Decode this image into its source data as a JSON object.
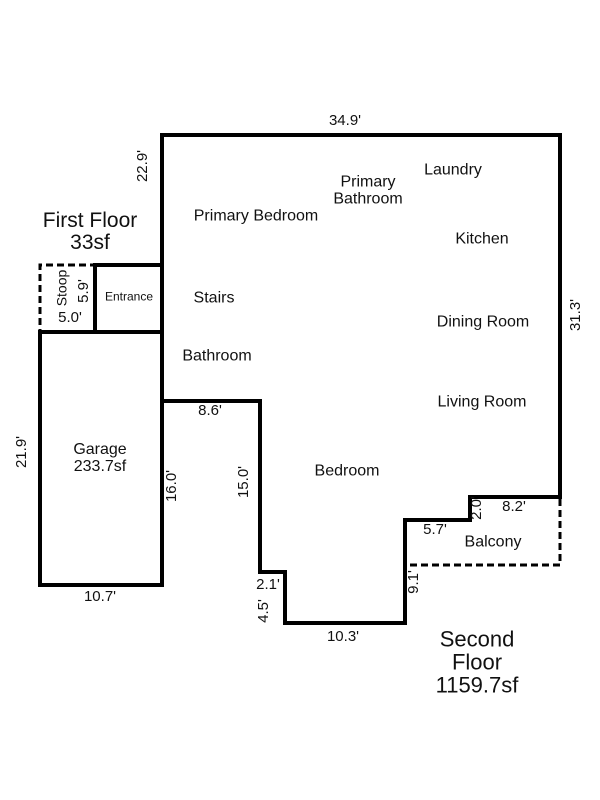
{
  "colors": {
    "walls": "#000000",
    "text": "#111111",
    "background": "#ffffff"
  },
  "first_floor": {
    "title": "First Floor",
    "area": "33sf",
    "rooms": {
      "stoop": "Stoop",
      "entrance": "Entrance"
    },
    "dimensions": {
      "stoop_width": "5.0'",
      "stoop_depth": "5.9'"
    }
  },
  "garage": {
    "name": "Garage",
    "area": "233.7sf",
    "dimensions": {
      "left_height": "21.9'",
      "bottom_width": "10.7'",
      "right_wall": "16.0'"
    }
  },
  "second_floor": {
    "title": "Second Floor",
    "area": "1159.7sf",
    "rooms": {
      "primary_bedroom": "Primary Bedroom",
      "primary_bathroom": "Primary\nBathroom",
      "laundry": "Laundry",
      "kitchen": "Kitchen",
      "dining_room": "Dining Room",
      "living_room": "Living Room",
      "stairs": "Stairs",
      "bathroom": "Bathroom",
      "bedroom": "Bedroom",
      "balcony": "Balcony"
    },
    "dimensions": {
      "top_width": "34.9'",
      "upper_left_height": "22.9'",
      "right_height": "31.3'",
      "hallway_width": "8.6'",
      "left_notch_height": "15.0'",
      "step_width": "2.1'",
      "step_height": "4.5'",
      "bottom_width": "10.3'",
      "balcony_left_height": "9.1'",
      "balcony_top_width": "5.7'",
      "balcony_step_height": "2.0'",
      "balcony_top_right_width": "8.2'"
    }
  }
}
